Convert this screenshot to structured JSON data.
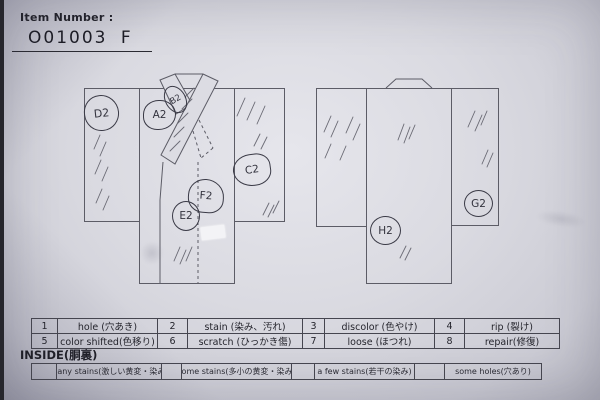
{
  "colors": {
    "paper": "#dadae1",
    "print_line": "#5c5c66",
    "pen_ink": "#3a3a46"
  },
  "header": {
    "item_number_label": "Item Number :",
    "item_number_value": "O01003 F"
  },
  "area_labels": {
    "a": "A2",
    "b": "B2",
    "c": "C2",
    "d": "D2",
    "e": "E2",
    "f": "F2",
    "g": "G2",
    "h": "H2"
  },
  "legend": {
    "rows": [
      [
        "1",
        "hole (穴あき)",
        "2",
        "stain (染み、汚れ)",
        "3",
        "discolor (色やけ)",
        "4",
        "rip (裂け)"
      ],
      [
        "5",
        "color shifted(色移り)",
        "6",
        "scratch (ひっかき傷)",
        "7",
        "loose (ほつれ)",
        "8",
        "repair(修復)"
      ]
    ]
  },
  "inside": {
    "label": "INSIDE(胴裏)",
    "cells": [
      "",
      "many stains(激しい黄変・染み)",
      "",
      "some stains(多小の黄変・染み)",
      "",
      "a few stains(若干の染み)",
      "",
      "some holes(穴あり)"
    ]
  }
}
